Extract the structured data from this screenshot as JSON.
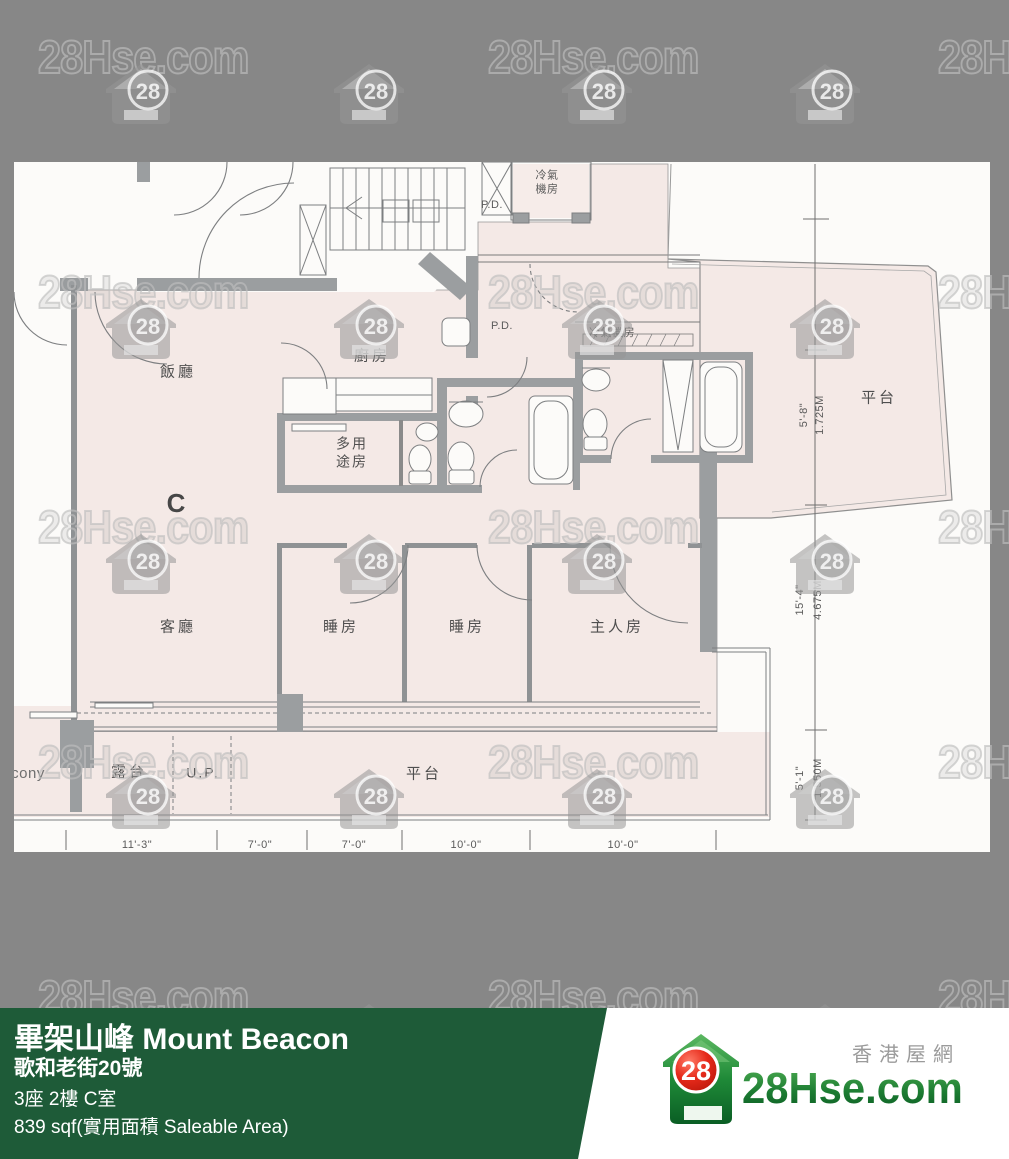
{
  "watermark": {
    "text": "28Hse.com",
    "badge": "28"
  },
  "floorplan": {
    "rooms": {
      "dining": "飯廳",
      "kitchen": "廚房",
      "pd_top": "P.D.",
      "pd_mid": "P.D.",
      "ac_top_line1": "冷氣",
      "ac_top_line2": "機房",
      "ac_right": "冷氣機房",
      "multi_line1": "多用",
      "multi_line2": "途房",
      "unit_letter": "C",
      "living": "客廳",
      "bedroom1": "睡房",
      "bedroom2": "睡房",
      "master": "主人房",
      "balcony_en": "Balcony",
      "balcony_zh": "露台",
      "utility_platform": "U.P.",
      "terrace_bottom": "平台",
      "terrace_right": "平台"
    },
    "dimensions": {
      "right": [
        {
          "ft": "5'-8\"",
          "m": "1.725M"
        },
        {
          "ft": "15'-4\"",
          "m": "4.675M"
        },
        {
          "ft": "5'-1\"",
          "m": "1.550M"
        }
      ],
      "bottom": [
        "11'-3\"",
        "7'-0\"",
        "7'-0\"",
        "10'-0\"",
        "10'-0\""
      ]
    }
  },
  "banner": {
    "title": "畢架山峰 Mount Beacon",
    "address": "歌和老街20號",
    "unit": "3座 2樓 C室",
    "area": "839 sqf(實用面積 Saleable Area)",
    "color": "#1e5b38"
  },
  "logo": {
    "badge": "28",
    "site": "28Hse.com",
    "tagline": "香港屋網"
  }
}
